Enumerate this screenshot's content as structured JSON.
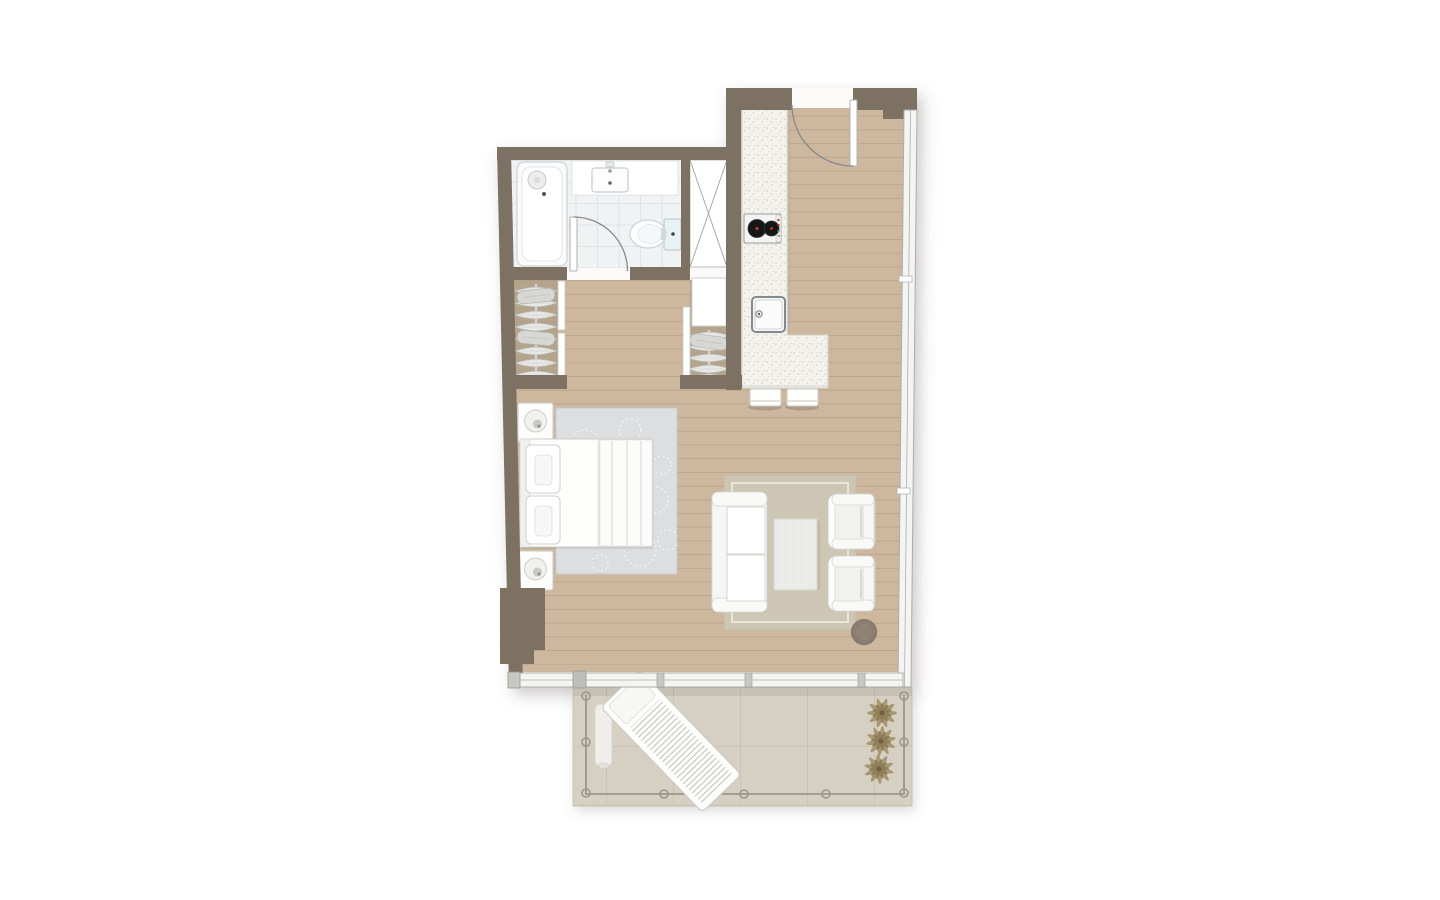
{
  "colors": {
    "background": "#ffffff",
    "wall": "#7d7164",
    "floor_wood": "#cdb89f",
    "plank_line": "#b19c83",
    "closet_floor": "#b5a48c",
    "tile_floor": "#f0f2f3",
    "tile_line": "#e0e4e7",
    "counter": "#f3f2ec",
    "glass": "#f4f4f3",
    "frame": "#adadab",
    "balcony_floor": "#d6d0c3",
    "balcony_grid": "#c7c0b2",
    "bedroom_rug": "#dcdee0",
    "living_rug": "#cec6b4",
    "furniture_fill": "#fdfdfc",
    "furniture_stroke": "#cbcbc8",
    "pouf": "#8b7e70",
    "plant": "#a3926a",
    "plant_dark": "#8b7a55",
    "burner": "#161616",
    "accent_red": "#c0392b",
    "railing": "#9d968a",
    "door_arc": "#8a8a8a",
    "shadow": "#5a5248"
  },
  "plan": {
    "rooms": [
      {
        "name": "bathroom"
      },
      {
        "name": "storage-closet"
      },
      {
        "name": "dressing-area"
      },
      {
        "name": "kitchen"
      },
      {
        "name": "entry"
      },
      {
        "name": "bedroom-living-area"
      },
      {
        "name": "balcony"
      }
    ],
    "furniture": [
      "bathtub",
      "vanity-sink",
      "toilet",
      "wardrobe-hangers",
      "kitchen-counter",
      "cooktop",
      "kitchen-sink",
      "bar-stools",
      "double-bed",
      "nightstands",
      "table-lamps",
      "bedroom-rug",
      "sofa",
      "coffee-table",
      "armchairs",
      "living-rug",
      "pouf",
      "lounge-chair",
      "side-table",
      "planters"
    ]
  }
}
